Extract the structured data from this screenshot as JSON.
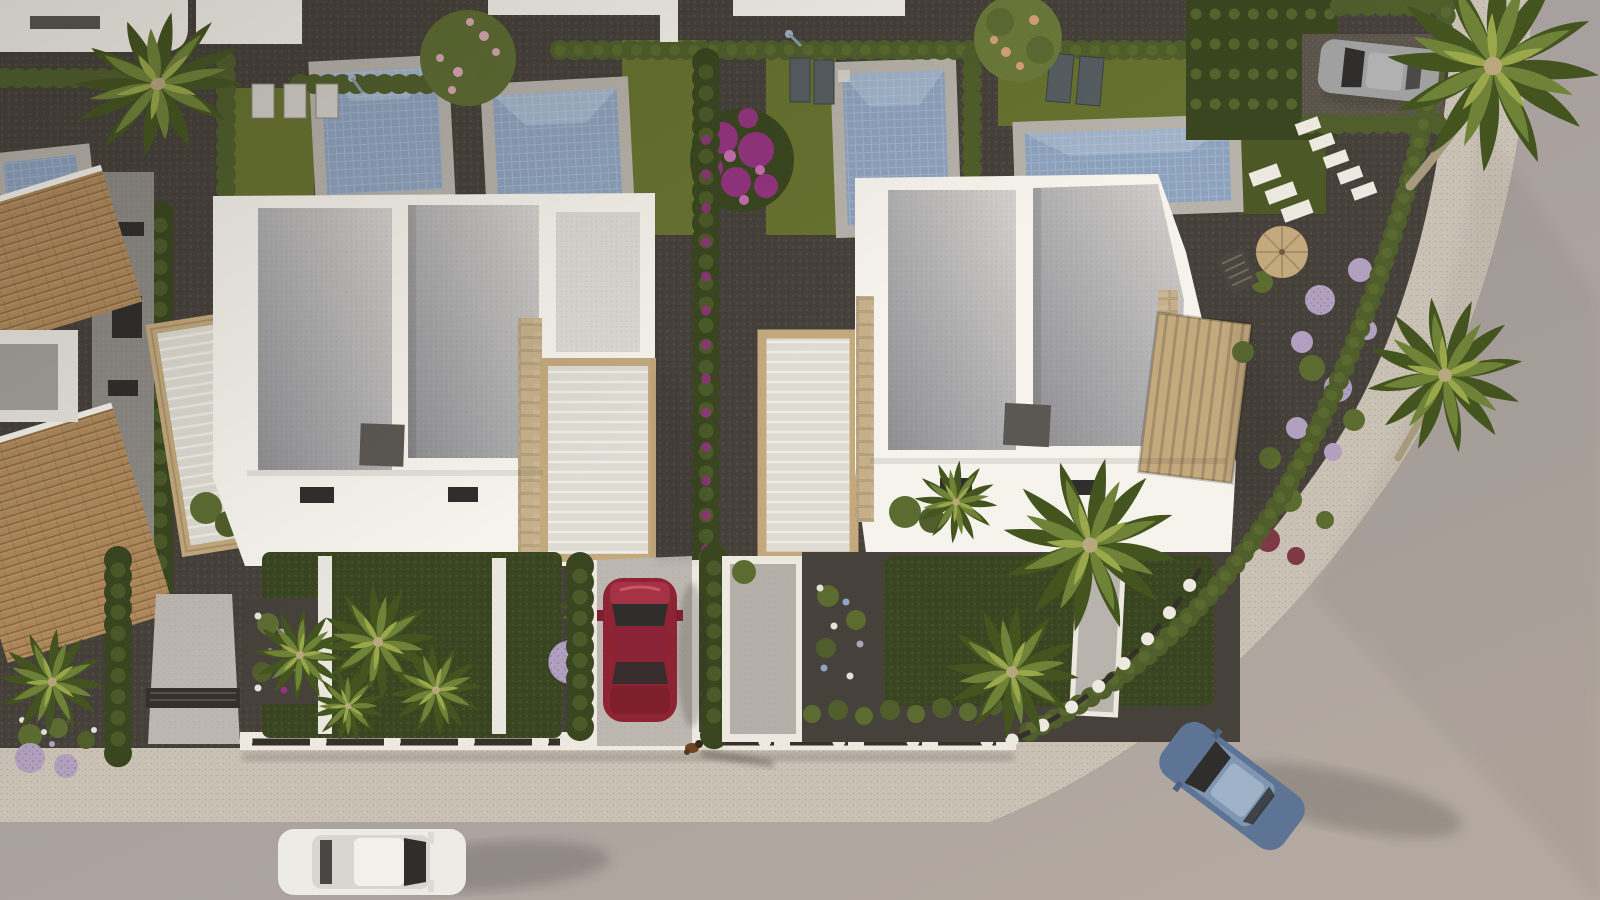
{
  "title": "aerial-3d-render-villa-development",
  "scene": {
    "type": "3d-aerial-architectural-render",
    "setting": "corner plot of a modern residential villa development at golden-hour, viewed top-down",
    "foreground_villas": 2,
    "background_roof_fragments": 5,
    "pools_visible": 5,
    "vehicles": [
      {
        "name": "red-hatchback-parked-driveway",
        "color": "#8e2433"
      },
      {
        "name": "white-suv-driving-bottom-street",
        "color": "#edebe6"
      },
      {
        "name": "blue-sedan-driving-corner-road",
        "color": "#5d7494"
      },
      {
        "name": "silver-car-parked-rear-driveway",
        "color": "#9fa09f"
      }
    ],
    "animals": [
      {
        "name": "dog-on-sidewalk",
        "color": "#6e4423"
      }
    ],
    "landscaping": [
      "palm trees",
      "cypress hedges",
      "bougainvillea",
      "lilac ball shrubs",
      "lawns",
      "dark gravel beds",
      "stepping stones",
      "sun loungers",
      "parasol with deck chair"
    ]
  },
  "palette": {
    "gravel_dark": "#46413a",
    "gravel_mid": "#5a544a",
    "lawn": "#67722f",
    "lawn_dark": "#4c5826",
    "hedge": "#4f5e2b",
    "hedge_dark": "#39461f",
    "shrub": "#5c6c31",
    "roof_light": "#d4d1cd",
    "roof_dark": "#8f8e91",
    "white_sun": "#f6f3ec",
    "white": "#e9e6df",
    "white_shade": "#d3d0c9",
    "stone": "#c6b08a",
    "stone_dark": "#a08a63",
    "terracotta": "#b08a5c",
    "terracotta_dark": "#7e6340",
    "pool_water": "#8da2bd",
    "pool_light": "#b3c2d4",
    "pool_deck": "#b7b2aa",
    "road": "#a49ea4",
    "road_warm": "#aba29a",
    "sidewalk": "#cac2b5",
    "curb": "#ede9e0",
    "fence_dark": "#35302a",
    "glass": "#2f2e2c",
    "ac_gray": "#5b5752",
    "facade_gray": "#8e8b86",
    "car_red": "#8e2433",
    "car_white": "#edebe6",
    "car_blue": "#5d7494",
    "car_gray": "#9fa09f",
    "palm": "#6f8338",
    "palm_dark": "#44541f",
    "palm_light": "#9aa84b",
    "flower_magenta": "#93337f",
    "flower_lilac": "#b2a0c0",
    "flower_white": "#e3e2da",
    "flower_red": "#7d3a45",
    "flower_blue": "#8ea7c8",
    "wood": "#c4a97d",
    "pergola_roof": "#dedbd2",
    "shadow": "#2a2724",
    "concrete": "#bcb8b1"
  }
}
